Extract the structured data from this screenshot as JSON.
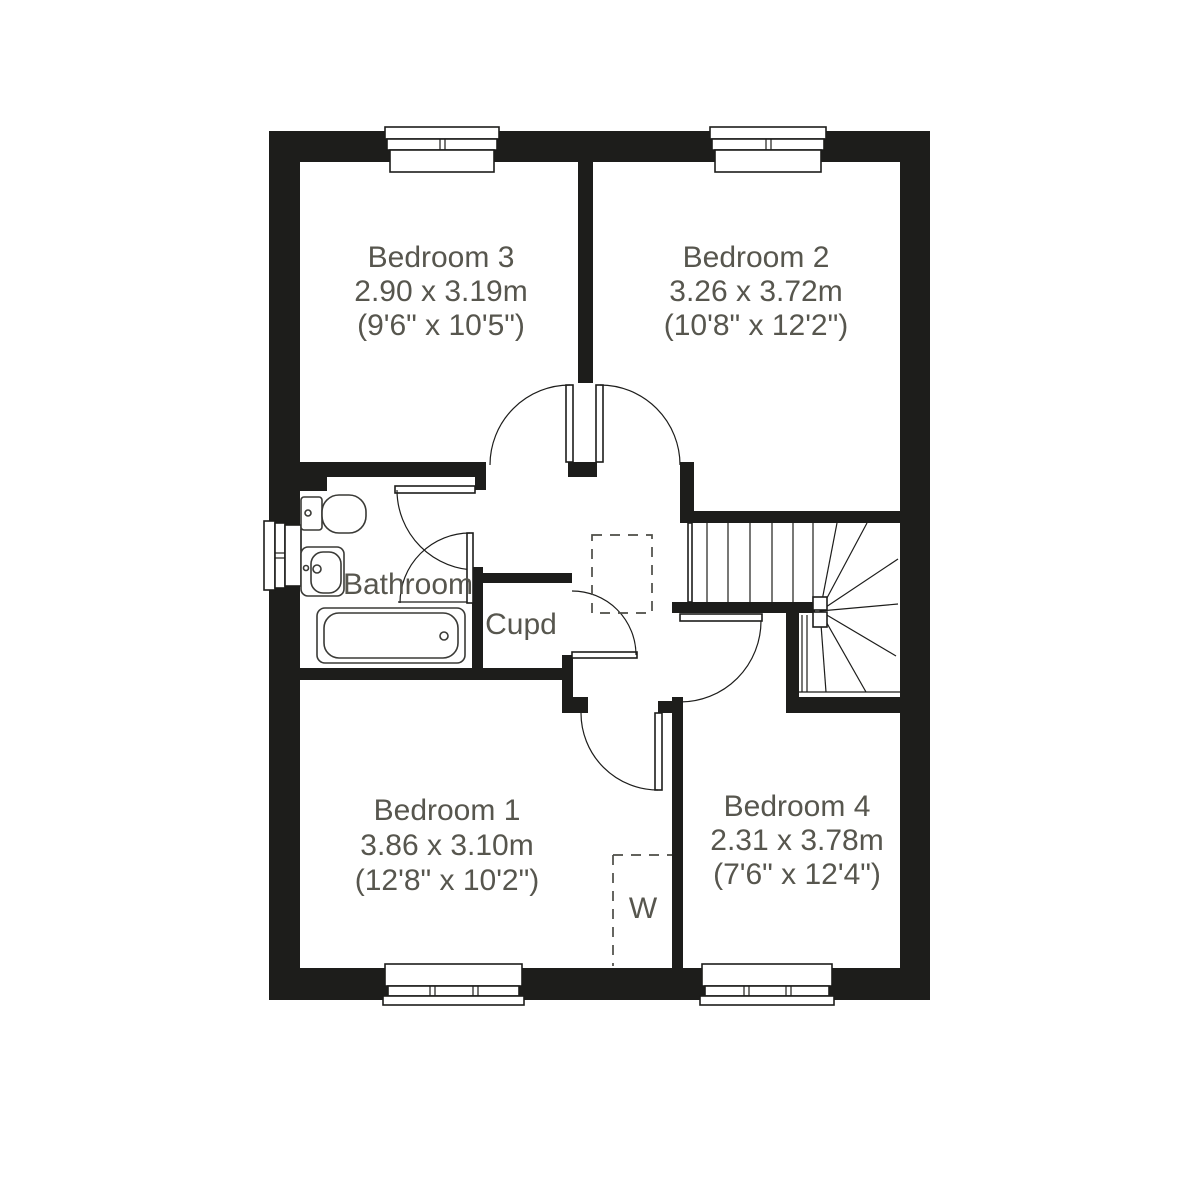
{
  "title": "First floor plan",
  "colors": {
    "wall": "#1d1d1b",
    "line": "#1d1d1b",
    "text": "#57564e",
    "background": "#ffffff"
  },
  "rooms": {
    "bedroom3": {
      "name": "Bedroom 3",
      "metric": "2.90 x 3.19m",
      "imperial": "(9'6\" x 10'5\")"
    },
    "bedroom2": {
      "name": "Bedroom 2",
      "metric": "3.26 x 3.72m",
      "imperial": "(10'8\" x 12'2\")"
    },
    "bedroom1": {
      "name": "Bedroom 1",
      "metric": "3.86 x 3.10m",
      "imperial": "(12'8\" x 10'2\")"
    },
    "bedroom4": {
      "name": "Bedroom 4",
      "metric": "2.31 x 3.78m",
      "imperial": "(7'6\" x 12'4\")"
    },
    "bathroom": {
      "name": "Bathroom"
    },
    "cupboard": {
      "name": "Cupd"
    },
    "wardrobe": {
      "name": "W"
    }
  }
}
